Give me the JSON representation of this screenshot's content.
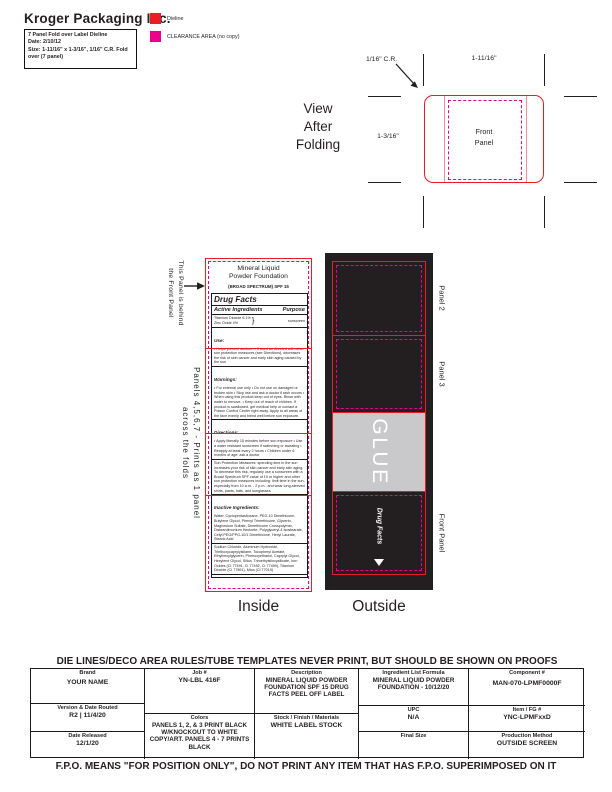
{
  "header": {
    "company": "Kroger Packaging Inc.",
    "spec_box": {
      "line1": "7 Panel Fold over Label Dieline",
      "line2": "Date: 2/10/12",
      "line3": "Size: 1-11/16\" x 1-3/16\", 1/16\" C.R. Fold over (7 panel)"
    },
    "legend": [
      {
        "name": "dieline",
        "color": "#ed1c24",
        "label": "Dieline"
      },
      {
        "name": "clearance-area",
        "color": "#ec008c",
        "label": "CLEARANCE AREA (no copy)"
      }
    ]
  },
  "fold_view": {
    "title": "View\nAfter\nFolding",
    "corner_radius_label": "1/16\" C.R.",
    "width_label": "1-11/16\"",
    "height_label": "1-3/16\"",
    "front_panel_label": "Front\nPanel"
  },
  "inside": {
    "caption": "Inside",
    "behind_note": {
      "line1": "This Panel is behind",
      "line2": "the Front Panel"
    },
    "panels_note": {
      "line1": "Panels 4,5,6,7 - Prints as 1 panel",
      "line2": "across the folds"
    },
    "label_title": "Mineral Liquid\nPowder Foundation",
    "label_subtitle": "(BROAD SPECTRUM) SPF 15",
    "drug_facts": {
      "title": "Drug Facts",
      "active_header": "Active Ingredients",
      "purpose_header": "Purpose",
      "actives_line1": "Titanium Dioxide 6.1%",
      "actives_line2": "Zinc Oxide 4%",
      "brace": "}",
      "purpose_value": "sunscreen",
      "use_title": "Use:",
      "use_text": "• Helps prevent sunburn • If used as directed with other sun protection measures (see Directions), decreases the risk of skin cancer and early skin aging caused by the sun",
      "warnings_title": "Warnings:",
      "warnings_text": "• For external use only • Do not use on damaged or broken skin • Stop use and ask a doctor if rash occurs • When using this product keep out of eyes. Rinse with water to remove. • Keep out of reach of children. If product is swallowed, get medical help or contact a Poison Control Center right away. Apply to all areas of the face evenly and blend well before sun exposure.",
      "directions_title": "Directions:",
      "directions_text": "• Apply liberally 15 minutes before sun exposure • Use a water resistant sunscreen if swimming or sweating • Reapply at least every 2 hours • Children under 6 months of age: ask a doctor",
      "directions_cont_text": "Sun Protection Measures: spending time in the sun increases your risk of skin cancer and early skin aging. To decrease this risk, regularly use a sunscreen with a Broad Spectrum SPF value of 15 or higher and other sun protection measures including: limit time in the sun, especially from 10 a.m. - 2 p.m., and wear long-sleeved shirts, pants, hats, and sunglasses",
      "inactive_title": "Inactive Ingredients:",
      "inactive_text": "Water, Cyclopentasiloxane, PEG-10 Dimethicone, Butylene Glycol, Phenyl Trimethicone, Glycerin, Magnesium Sulfate, Dimethicone Crosspolymer, Disteardimonium Hectorite, Polyglyceryl-4 Isostearate, Cetyl PEG/PPG-10/1 Dimethicone, Hexyl Laurate, Stearic Acid",
      "inactive_cont_text": "Sodium Chloride, Aluminum Hydroxide, Triethoxycaprylylsilane, Tocopheryl Acetate, Ethylhexylglycerin, Phenoxyethanol, Caprylyl Glycol, Hexylene Glycol, Silica, Trimethylsiloxysilicate, Iron Oxides (CI 77491, CI 77492, CI 77499), Titanium Dioxide (CI 77891), Mica (CI 77019)",
      "other_title": "Other Information:",
      "other_text": "• Protect this product from excessive heat and direct sun"
    }
  },
  "outside": {
    "caption": "Outside",
    "panel2_label": "Panel 2",
    "panel3_label": "Panel 3",
    "glue_label": "GLUE",
    "front_panel_label": "Front Panel",
    "front_panel_text": "Drug Facts"
  },
  "colors": {
    "dieline_red": "#ed1c24",
    "clearance_magenta": "#ec008c",
    "print_black": "#231f20",
    "glue_gray": "#c9c9cb"
  },
  "spec_table": {
    "banner": "DIE LINES/DECO AREA RULES/TUBE TEMPLATES NEVER PRINT, BUT SHOULD BE SHOWN ON PROOFS",
    "brand": {
      "label": "Brand",
      "value": "YOUR NAME"
    },
    "job": {
      "label": "Job #",
      "value": "YN-LBL 416F"
    },
    "description": {
      "label": "Description",
      "value": "MINERAL LIQUID POWDER FOUNDATION SPF 15 DRUG FACTS PEEL OFF LABEL"
    },
    "ingredient": {
      "label": "Ingredient List Formula",
      "value": "MINERAL LIQUID POWDER FOUNDATION - 10/12/20"
    },
    "component": {
      "label": "Component #",
      "value": "MAN-070-LPMF0000F"
    },
    "version": {
      "label": "Version & Date Routed",
      "value": "R2   |   11/4/20"
    },
    "released": {
      "label": "Date Released",
      "value": "12/1/20"
    },
    "colors": {
      "label": "Colors",
      "value": "PANELS 1, 2, & 3 PRINT BLACK W/KNOCKOUT TO WHITE COPY/ART. PANELS 4 - 7 PRINTS BLACK"
    },
    "stock": {
      "label": "Stock / Finish / Materials",
      "value": "WHITE LABEL STOCK"
    },
    "upc": {
      "label": "UPC",
      "value": "N/A"
    },
    "item": {
      "label": "Item / FG #",
      "value": "YNC-LPMFxxD"
    },
    "final_size": {
      "label": "Final Size",
      "value": ""
    },
    "production": {
      "label": "Production Method",
      "value": "OUTSIDE SCREEN"
    }
  },
  "footer_note": "F.P.O. MEANS \"FOR POSITION ONLY\", DO NOT PRINT ANY ITEM THAT HAS F.P.O. SUPERIMPOSED ON IT"
}
